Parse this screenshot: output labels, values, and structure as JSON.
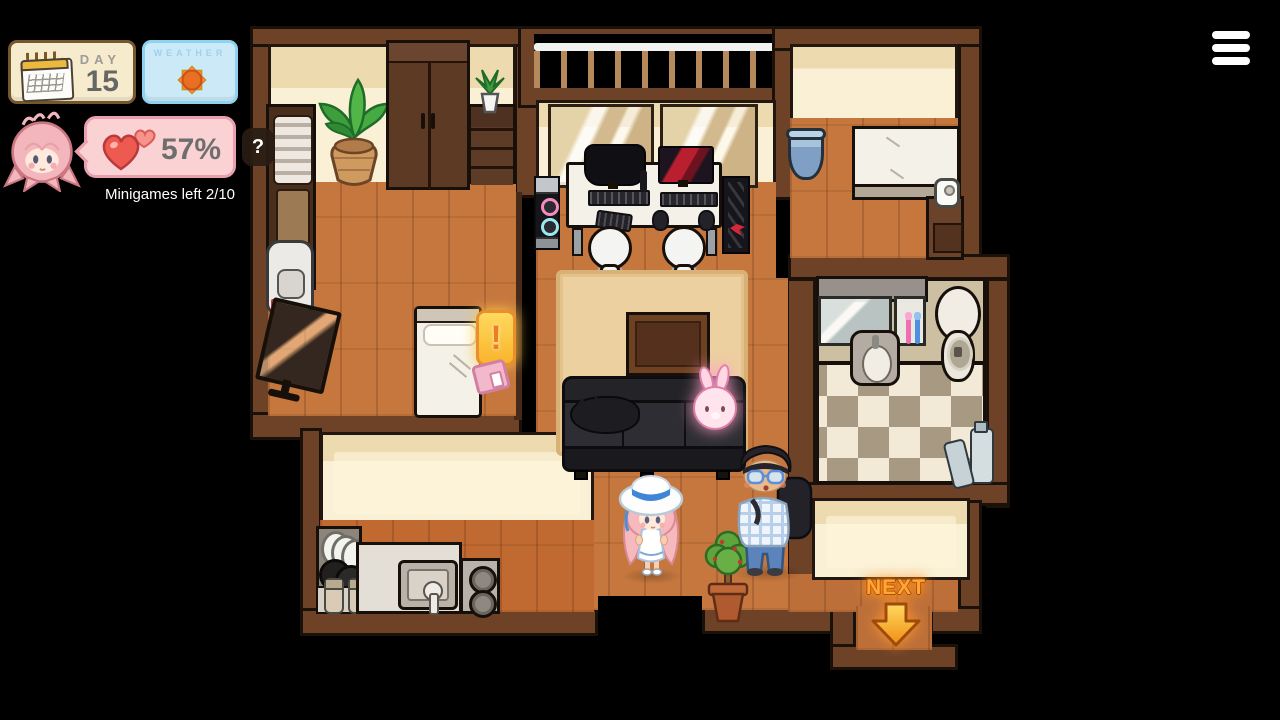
{
  "hud": {
    "day_panel": {
      "label": "DAY",
      "value": "15"
    },
    "weather_panel": {
      "label": "WEATHER"
    },
    "affection_panel": {
      "value": "57%"
    },
    "minigames_status": "Minigames left 2/10",
    "question_hint": "?",
    "alert_badge": "!"
  },
  "nav": {
    "next_label": "NEXT"
  },
  "icons": {
    "menu": "hamburger-menu-icon",
    "weather": "sun-icon",
    "affection": "heart-icon",
    "day": "calendar-icon",
    "next": "down-arrow-icon",
    "alert": "exclamation-icon",
    "question": "question-mark-icon"
  },
  "colors": {
    "background": "#000000",
    "wall_brown": "#6e4227",
    "floor_wood": "#c5773e",
    "wallpaper_cream": "#f9f0d6",
    "rug_tan": "#edd0a0",
    "day_panel_bg": "#f7ebcd",
    "weather_panel_bg": "#cbe9f7",
    "affection_panel_bg": "#fbd2d4",
    "next_orange": "#ffa63a"
  }
}
